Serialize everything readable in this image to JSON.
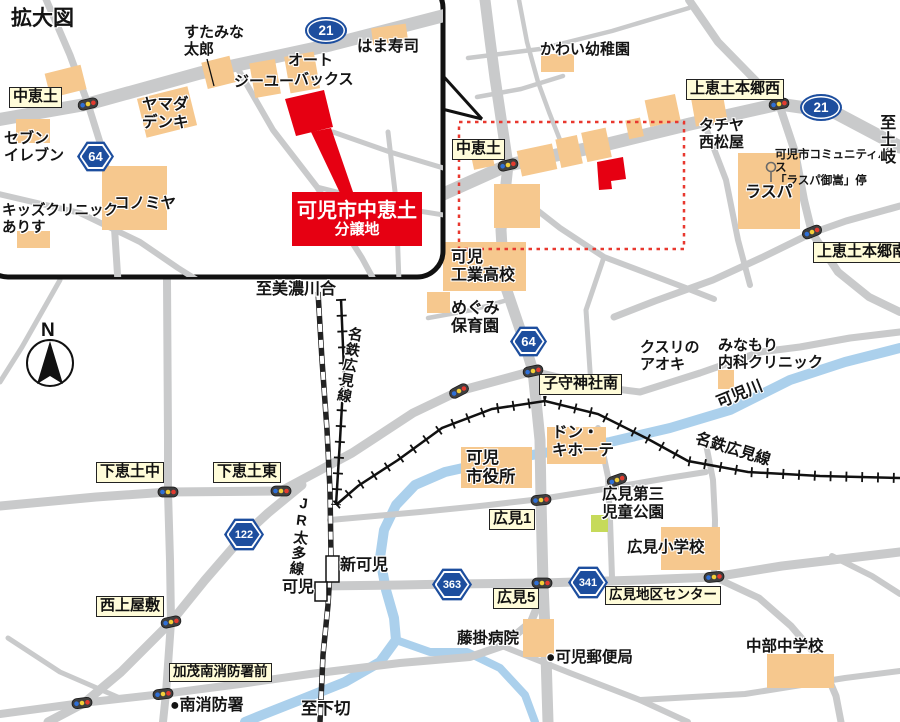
{
  "colors": {
    "road": "#c9cacb",
    "building": "#f6c88e",
    "river": "#abd0ec",
    "site_red": "#e60012",
    "badge_blue": "#1d4e9e",
    "label_yellow": "#fffcd9",
    "park_green": "#c6da5a"
  },
  "compass": {
    "north": "N"
  },
  "inset": {
    "title": "拡大図",
    "badges": {
      "r21": "21",
      "r64": "64"
    },
    "labels": {
      "nakaedo": "中恵土",
      "sutamina": "すたみな\n太郎",
      "hamazushi": "はま寿司",
      "auto": "オート",
      "gu": "ジーユー",
      "backs": "バックス",
      "yamada": "ヤマダ\nデンキ",
      "seven": "セブン\nイレブン",
      "konomiya": "コノミヤ",
      "kids": "キッズクリニック\nありす"
    },
    "site": {
      "line1": "可児市中恵土",
      "line2": "分譲地"
    }
  },
  "main": {
    "badges": {
      "r21": "21",
      "r64": "64",
      "r122": "122",
      "r363": "363",
      "r341": "341"
    },
    "intersections": {
      "nakaedo": "中恵土",
      "kamiedo_w": "上恵土本郷西",
      "kamiedo_s": "上恵土本郷南",
      "komori": "子守神社南",
      "shimoedo_naka": "下恵土中",
      "shimoedo_e": "下恵土東",
      "nishikamiyashiki": "西上屋敷",
      "kamo": "加茂南消防署前",
      "hiromi1": "広見1",
      "hiromi5": "広見5",
      "hiromi_center": "広見地区センター"
    },
    "places": {
      "kawai": "かわい幼稚園",
      "tachiya": "タチヤ\n西松屋",
      "bus_stop": "可児市コミュニティバス\n「ラスパ御嵩」停",
      "laspa": "ラスパ",
      "kani_kogyo": "可児\n工業高校",
      "megumi": "めぐみ\n保育園",
      "kusuri": "クスリの\nアオキ",
      "minamori": "みなもり\n内科クリニック",
      "donki": "ドン・\nキホーテ",
      "shiyakusho": "可児\n市役所",
      "hiromi_park": "広見第三\n児童公園",
      "hiromi_sho": "広見小学校",
      "chubu": "中部中学校",
      "fujikake": "藤掛病院",
      "post": "●可児郵便局",
      "fire_south": "●南消防署",
      "shinkani": "新可児",
      "kani": "可児"
    },
    "directions": {
      "mino": "至美濃川合",
      "toki": "至土岐",
      "shimogiri": "至下切"
    },
    "lines": {
      "kanigawa": "可児川",
      "meitetsu_v": "名鉄広見線",
      "meitetsu_e": "名鉄広見線",
      "jr": "JR太多線"
    }
  }
}
